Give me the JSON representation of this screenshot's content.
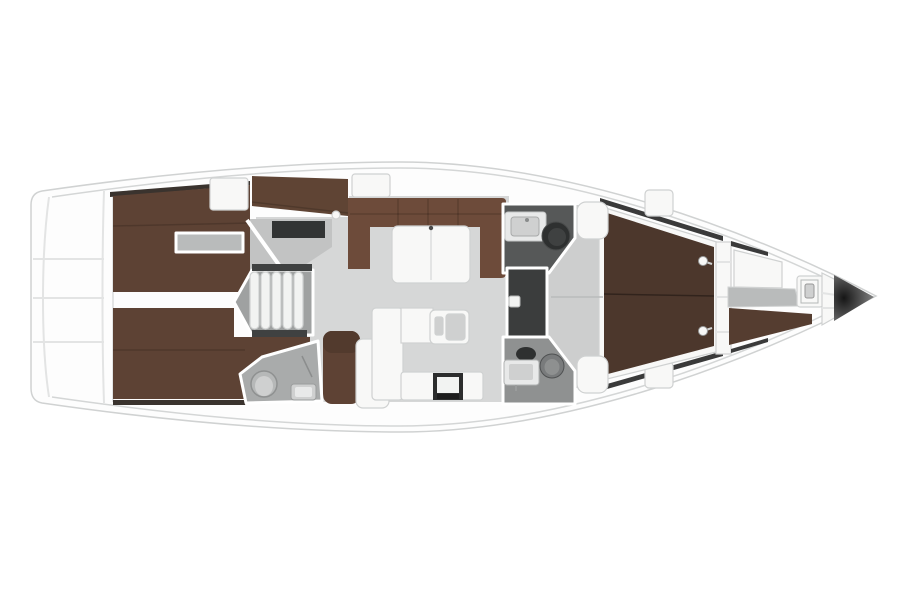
{
  "figure": {
    "type": "yacht-interior-floor-plan",
    "view": "top-down",
    "bow_direction": "right",
    "stern_direction": "left"
  },
  "rooms": [
    {
      "name": "swim-platform"
    },
    {
      "name": "aft-cabin-port"
    },
    {
      "name": "aft-cabin-starboard"
    },
    {
      "name": "companionway-steps"
    },
    {
      "name": "salon"
    },
    {
      "name": "nav-station"
    },
    {
      "name": "galley"
    },
    {
      "name": "aft-head"
    },
    {
      "name": "midship-head-port"
    },
    {
      "name": "shower"
    },
    {
      "name": "midship-head-starboard"
    },
    {
      "name": "owners-cabin"
    },
    {
      "name": "forepeak"
    },
    {
      "name": "anchor-locker"
    }
  ],
  "colors": {
    "background": "#ffffff",
    "hull_fill": "#fdfdfd",
    "sheer_line": "#d4d6d6",
    "deck_seam": "#e4e5e5",
    "floor_salon": "#d6d7d7",
    "floor_entry": "#c2c3c3",
    "floor_fwd": "#cdcece",
    "floor_notch": "#b9bbbb",
    "floor_steps": "#9fa1a1",
    "floor_head_aft": "#a9abab",
    "floor_head_top": "#565858",
    "floor_head_bottom": "#8f9191",
    "shower_dark": "#3b3d3d",
    "step_white": "#f2f3f2",
    "berth_brown": "#5d4234",
    "berth_brown_fwd": "#4c372c",
    "sofa_brown": "#6d4b3a",
    "locker_brown": "#5f4434",
    "bench_brown_fwd": "#553d30",
    "nav_seat": "#5e4234",
    "nav_seat_back": "#523a2d",
    "wood_trim_dark": "#3a332e",
    "wardrobe_dark": "#323434",
    "dark_band": "#3f4141",
    "fixture_white": "#f8f8f7",
    "fixture_light": "#e8e9e9",
    "fixture_gray": "#cfd0d0",
    "fixture_mid": "#b6b8b8",
    "stove_dark": "#2c2d2d",
    "stove_band": "#1d1d1d",
    "toilet_dark": "#2e3030",
    "toilet_gray": "#797b7c",
    "window_dark": "#3a3a3a",
    "anchor_core": "#161616",
    "anchor_edge": "#909090"
  }
}
